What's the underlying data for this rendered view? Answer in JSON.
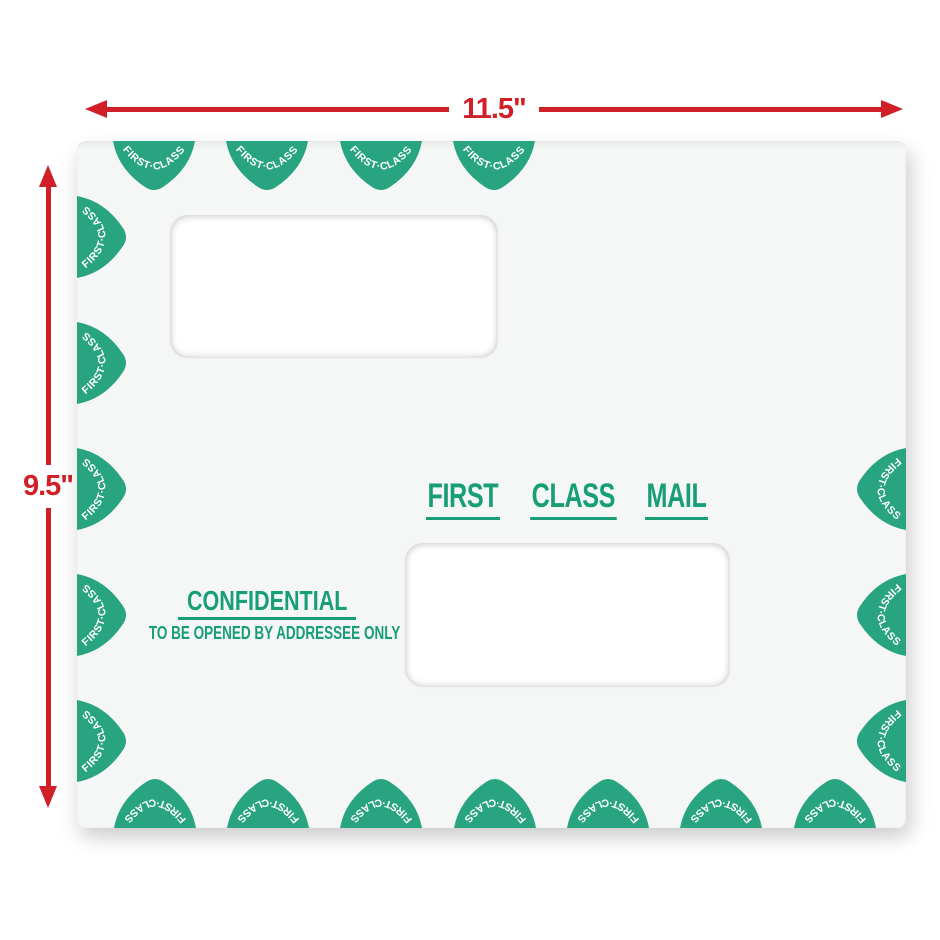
{
  "dimensions": {
    "width_label": "11.5\"",
    "height_label": "9.5\""
  },
  "envelope": {
    "stamp_label": "FIRST·CLASS",
    "first_class_mail_words": [
      "FIRST",
      "CLASS",
      "MAIL"
    ],
    "confidential_label": "CONFIDENTIAL",
    "addressee_note": "TO BE OPENED BY ADDRESSEE ONLY"
  },
  "colors": {
    "arrow_red": "#d11f27",
    "print_green": "#189e77",
    "stamp_green": "#29a480",
    "envelope_paper": "#f5f7f6",
    "window_white": "#ffffff",
    "page_background": "#ffffff"
  }
}
